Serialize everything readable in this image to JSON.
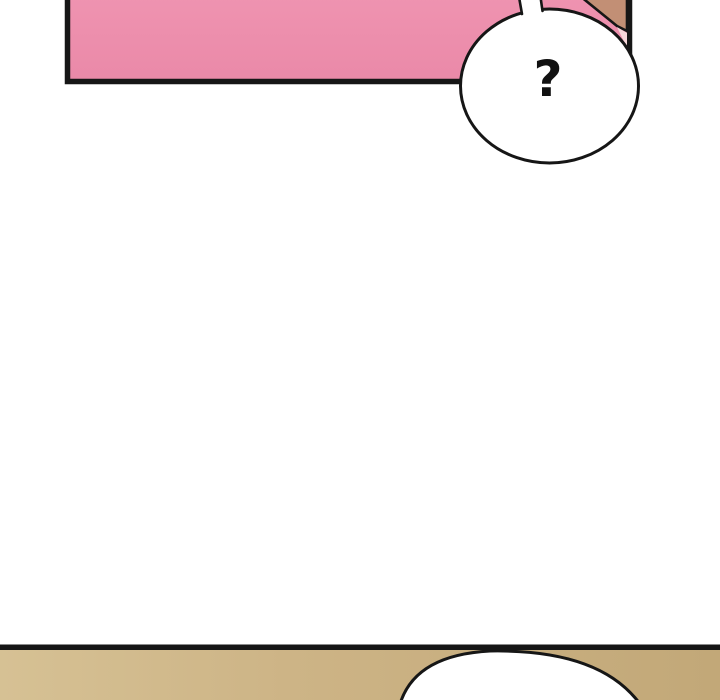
{
  "artwork": {
    "kind": "comic-strip-panels",
    "top_panel": {
      "speech_bubble": {
        "text": "?"
      }
    }
  },
  "colors": {
    "background": "#ffffff",
    "outline": "#161616",
    "panel_pink_top": "#f29ab6",
    "panel_pink_bottom": "#ea89a8",
    "skin_tan": "#c28f75",
    "skin_accent_pink": "#f7d7da",
    "bubble_fill": "#ffffff",
    "bubble_text_color": "#111111",
    "floor_light": "#d6c194",
    "floor_mid": "#cdb486",
    "floor_dark": "#c2a878"
  }
}
